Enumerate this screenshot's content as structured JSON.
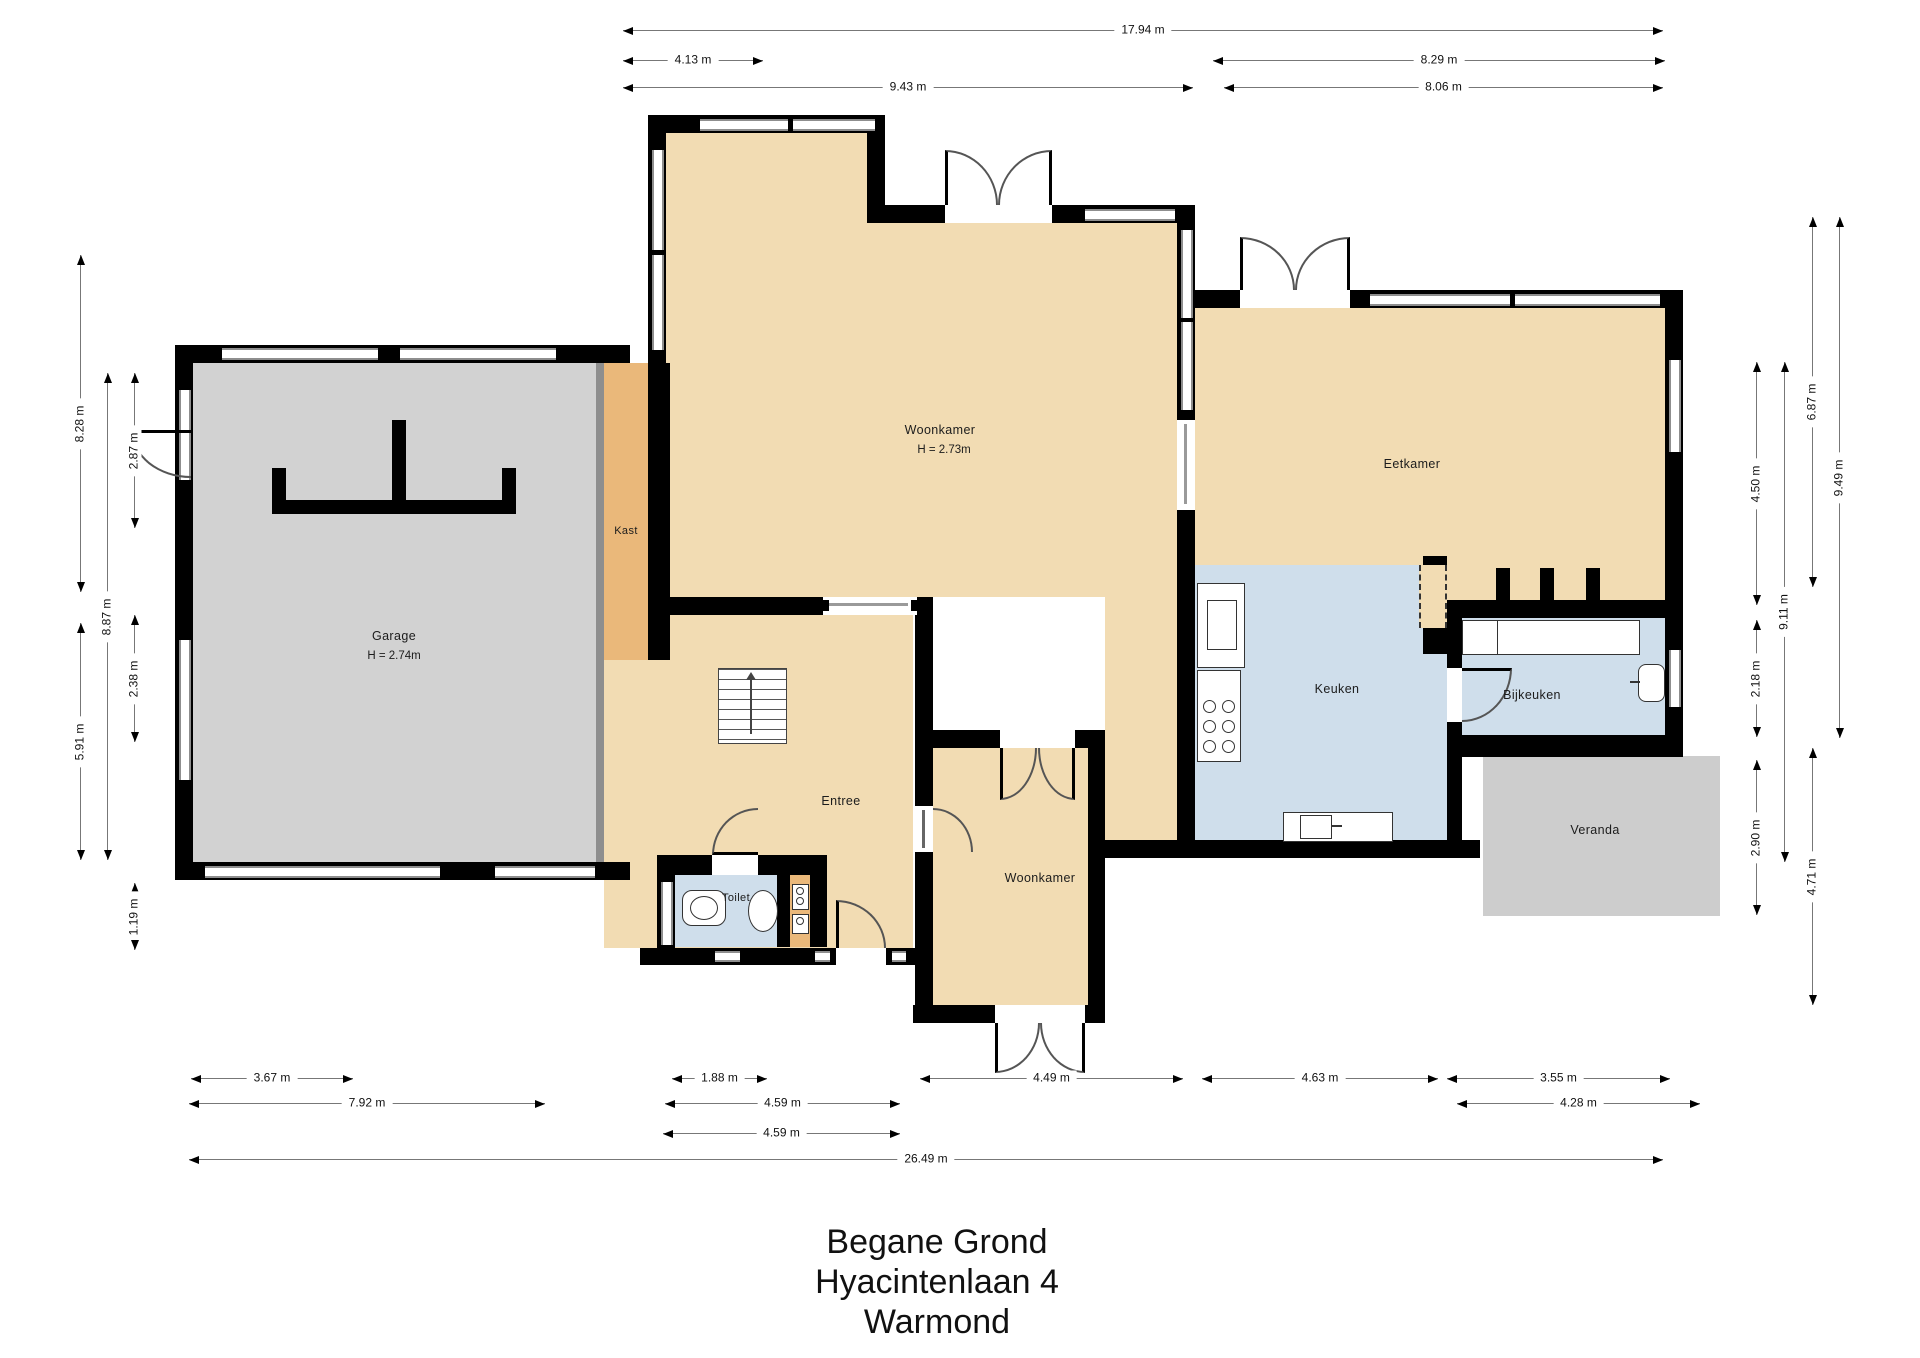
{
  "title": {
    "lines": [
      "Begane Grond",
      "Hyacintenlaan 4",
      "Warmond"
    ]
  },
  "rooms": {
    "woonkamer": {
      "label": "Woonkamer",
      "height": "H = 2.73m"
    },
    "garage": {
      "label": "Garage",
      "height": "H = 2.74m"
    },
    "kast": {
      "label": "Kast"
    },
    "eetkamer": {
      "label": "Eetkamer"
    },
    "keuken": {
      "label": "Keuken"
    },
    "bijkeuken": {
      "label": "Bijkeuken"
    },
    "veranda": {
      "label": "Veranda"
    },
    "entree": {
      "label": "Entree"
    },
    "toilet": {
      "label": "Toilet"
    },
    "woonkamer_lower": {
      "label": "Woonkamer"
    }
  },
  "dimensions": {
    "top": [
      {
        "value": "17.94 m"
      },
      {
        "value": "4.13 m"
      },
      {
        "value": "8.29 m"
      },
      {
        "value": "9.43 m"
      },
      {
        "value": "8.06 m"
      }
    ],
    "left": [
      {
        "value": "8.28 m"
      },
      {
        "value": "5.91 m"
      },
      {
        "value": "8.87 m"
      },
      {
        "value": "2.87 m"
      },
      {
        "value": "2.38 m"
      },
      {
        "value": "1.19 m"
      }
    ],
    "right": [
      {
        "value": "4.50 m"
      },
      {
        "value": "2.18 m"
      },
      {
        "value": "2.90 m"
      },
      {
        "value": "9.11 m"
      },
      {
        "value": "6.87 m"
      },
      {
        "value": "4.71 m"
      },
      {
        "value": "9.49 m"
      }
    ],
    "bottom": [
      {
        "value": "3.67 m"
      },
      {
        "value": "1.88 m"
      },
      {
        "value": "4.49 m"
      },
      {
        "value": "4.63 m"
      },
      {
        "value": "3.55 m"
      },
      {
        "value": "7.92 m"
      },
      {
        "value": "4.59 m"
      },
      {
        "value": "4.28 m"
      },
      {
        "value": "4.59 m"
      },
      {
        "value": "26.49 m"
      }
    ]
  },
  "colors": {
    "wall": "#000000",
    "floor_living": "#f2dcb3",
    "floor_closet": "#eab87a",
    "floor_garage": "#d2d2d2",
    "floor_wet": "#cfdeeb",
    "veranda": "#cdcdcd"
  }
}
